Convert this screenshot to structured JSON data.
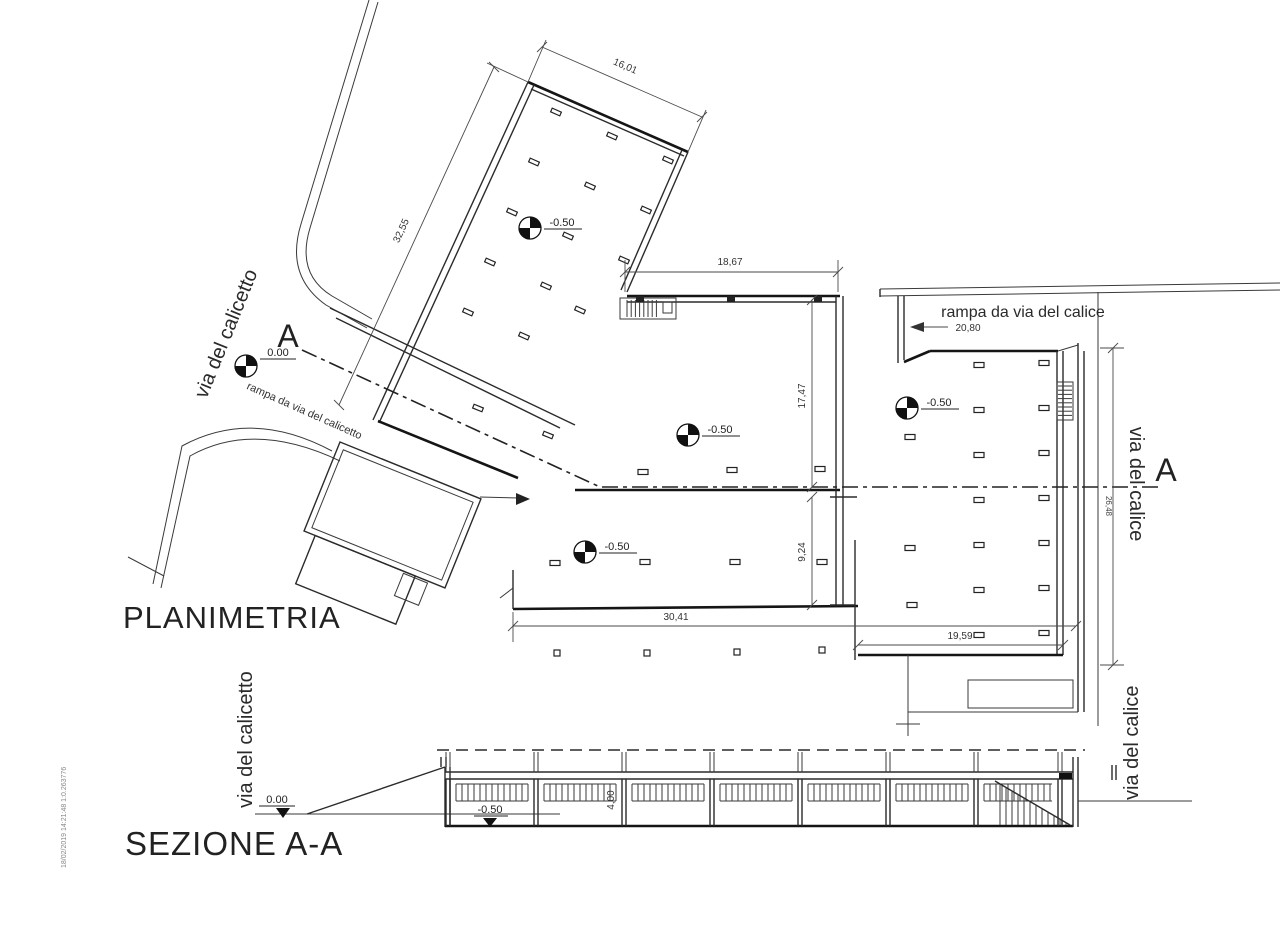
{
  "titles": {
    "plan": "PLANIMETRIA",
    "section": "SEZIONE A-A"
  },
  "labels": {
    "street_calicetto_plan": "via del calicetto",
    "street_calice_plan": "via del calice",
    "street_calicetto_section": "via del calicetto",
    "street_calice_section": "via del calice",
    "ramp_calicetto": "rampa da via del calicetto",
    "ramp_calice": "rampa da via del calice",
    "section_a": "A",
    "stamp": "18/02/2019 14:21:48  1:0.263776"
  },
  "levels": {
    "zero": "0.00",
    "minus": "-0.50"
  },
  "dimensions": {
    "hall_top": "16,01",
    "hall_left": "32,55",
    "mid_top": "18,67",
    "ramp_len": "20,80",
    "mid_height": "17,47",
    "low_height": "9,24",
    "bottom": "30,41",
    "wing_bottom": "19,59",
    "street_side": "26,48",
    "sec_height": "4,00"
  }
}
